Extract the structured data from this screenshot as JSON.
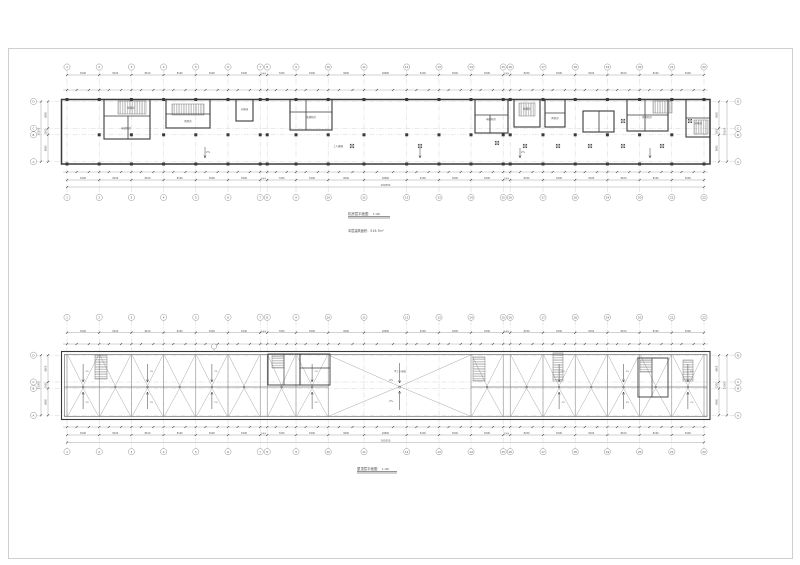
{
  "sheet": {
    "colors": {
      "background": "#ffffff",
      "frame": "#c4c4c4",
      "dark": "#3a3a3a",
      "mid": "#8f8f8f",
      "dim": "#9a9a9a",
      "grid": "#cfcfcf",
      "hatch": "#6a6a6a",
      "text": "#4f4f4f"
    }
  },
  "plans": [
    {
      "name": "machine-room-level-plan",
      "title": "机房层平面图",
      "scale": "1:100",
      "area_note": "本层建筑面积：519.7m²"
    },
    {
      "name": "roof-level-plan",
      "title": "屋顶层平面图",
      "scale": "1:100",
      "area_note": ""
    }
  ],
  "grid": {
    "col_labels": [
      "1",
      "2",
      "3",
      "4",
      "5",
      "6",
      "7",
      "8",
      "9",
      "10",
      "11",
      "12",
      "13",
      "14",
      "15",
      "16",
      "17",
      "18",
      "19",
      "20",
      "21",
      "22"
    ],
    "bay_dims": [
      "8100",
      "8100",
      "8100",
      "8100",
      "8100",
      "8100",
      "1800",
      "7200",
      "8100",
      "9000",
      "10800",
      "8100",
      "8100",
      "8100",
      "1800",
      "8250",
      "8100",
      "8100",
      "8100",
      "8100",
      "8100"
    ],
    "overall_dim": "160350",
    "row_labels": [
      "D",
      "C",
      "B",
      "A"
    ],
    "row_dims": [
      "6900",
      "1500",
      "6900"
    ],
    "row_overall": "15300"
  },
  "slope_label": "2%",
  "plan1_labels": [
    {
      "text": "楼梯间",
      "x": 131,
      "y": 108.5
    },
    {
      "text": "电梯机房",
      "x": 126,
      "y": 129
    },
    {
      "text": "风机房",
      "x": 188,
      "y": 122
    },
    {
      "text": "水箱间",
      "x": 244.5,
      "y": 110
    },
    {
      "text": "排烟机房",
      "x": 311,
      "y": 118
    },
    {
      "text": "电梯机房",
      "x": 491,
      "y": 120
    },
    {
      "text": "楼梯间",
      "x": 527,
      "y": 109.5
    },
    {
      "text": "风机房",
      "x": 555,
      "y": 119
    },
    {
      "text": "排风机房",
      "x": 647,
      "y": 118
    },
    {
      "text": "水箱间",
      "x": 698,
      "y": 124
    },
    {
      "text": "上人屋面",
      "x": 338,
      "y": 147
    },
    {
      "text": "2%",
      "x": 208,
      "y": 153
    },
    {
      "text": "2%",
      "x": 523,
      "y": 153
    }
  ],
  "plan2_labels": [
    {
      "text": "不上人屋面",
      "x": 400,
      "y": 372
    },
    {
      "text": "2%",
      "x": 391,
      "y": 381
    },
    {
      "text": "2%",
      "x": 391,
      "y": 402
    }
  ]
}
